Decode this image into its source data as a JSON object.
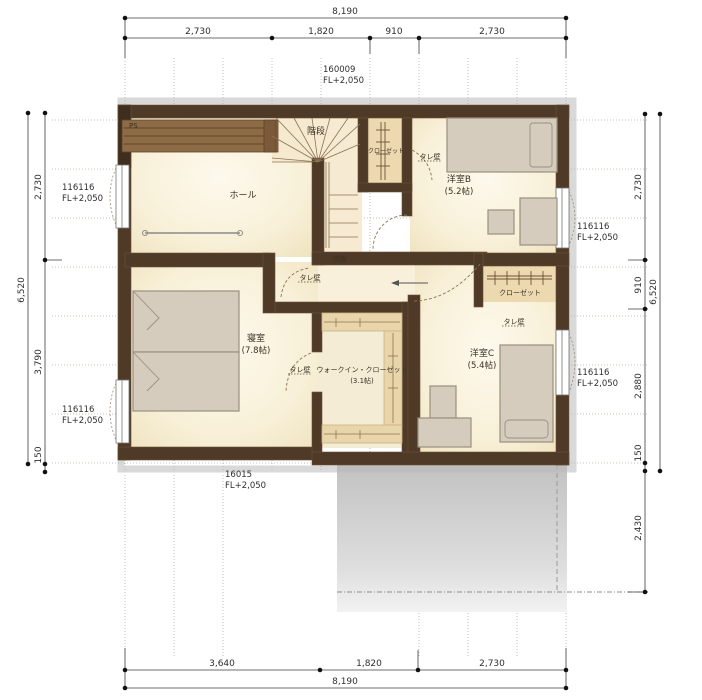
{
  "dims": {
    "top": {
      "total": "8,190",
      "s1": "2,730",
      "s2": "1,820",
      "s3": "910",
      "s4": "2,730"
    },
    "bottom": {
      "total": "8,190",
      "s1": "3,640",
      "s2": "1,820",
      "s3": "2,730"
    },
    "left": {
      "total": "6,520",
      "s1": "2,730",
      "s2": "3,790",
      "s3": "150"
    },
    "right": {
      "total": "6,520",
      "s1": "2,730",
      "s2": "910",
      "s3": "2,880",
      "s4": "150",
      "s5": "2,430"
    }
  },
  "codes": {
    "top": {
      "l1": "160009",
      "l2": "FL+2,050"
    },
    "left_top": {
      "l1": "116116",
      "l2": "FL+2,050"
    },
    "left_bottom": {
      "l1": "116116",
      "l2": "FL+2,050"
    },
    "right_top": {
      "l1": "116116",
      "l2": "FL+2,050"
    },
    "right_bottom": {
      "l1": "116116",
      "l2": "FL+2,050"
    },
    "bottom": {
      "l1": "16015",
      "l2": "FL+2,050"
    }
  },
  "rooms": {
    "ps": "PS",
    "hall": "ホール",
    "stairs": "階段",
    "void": "吹抜",
    "closet_b": "クローゼット",
    "bedroom_b": "洋室B",
    "bedroom_b_size": "(5.2帖)",
    "master": "寝室",
    "master_size": "(7.8帖)",
    "wic": "ウォークイン・クローゼット",
    "wic_size": "(3.1帖)",
    "bedroom_c": "洋室C",
    "bedroom_c_size": "(5.4帖)",
    "closet_c": "クローゼット",
    "tare_kabe": "タレ壁"
  },
  "colors": {
    "wall": "#4f3a27",
    "floor": "#f8f1dc",
    "closet": "#ecd9b0",
    "counter": "#8d6b47",
    "furniture": "#d6ccbe",
    "balcony": "#c6c6c6"
  }
}
